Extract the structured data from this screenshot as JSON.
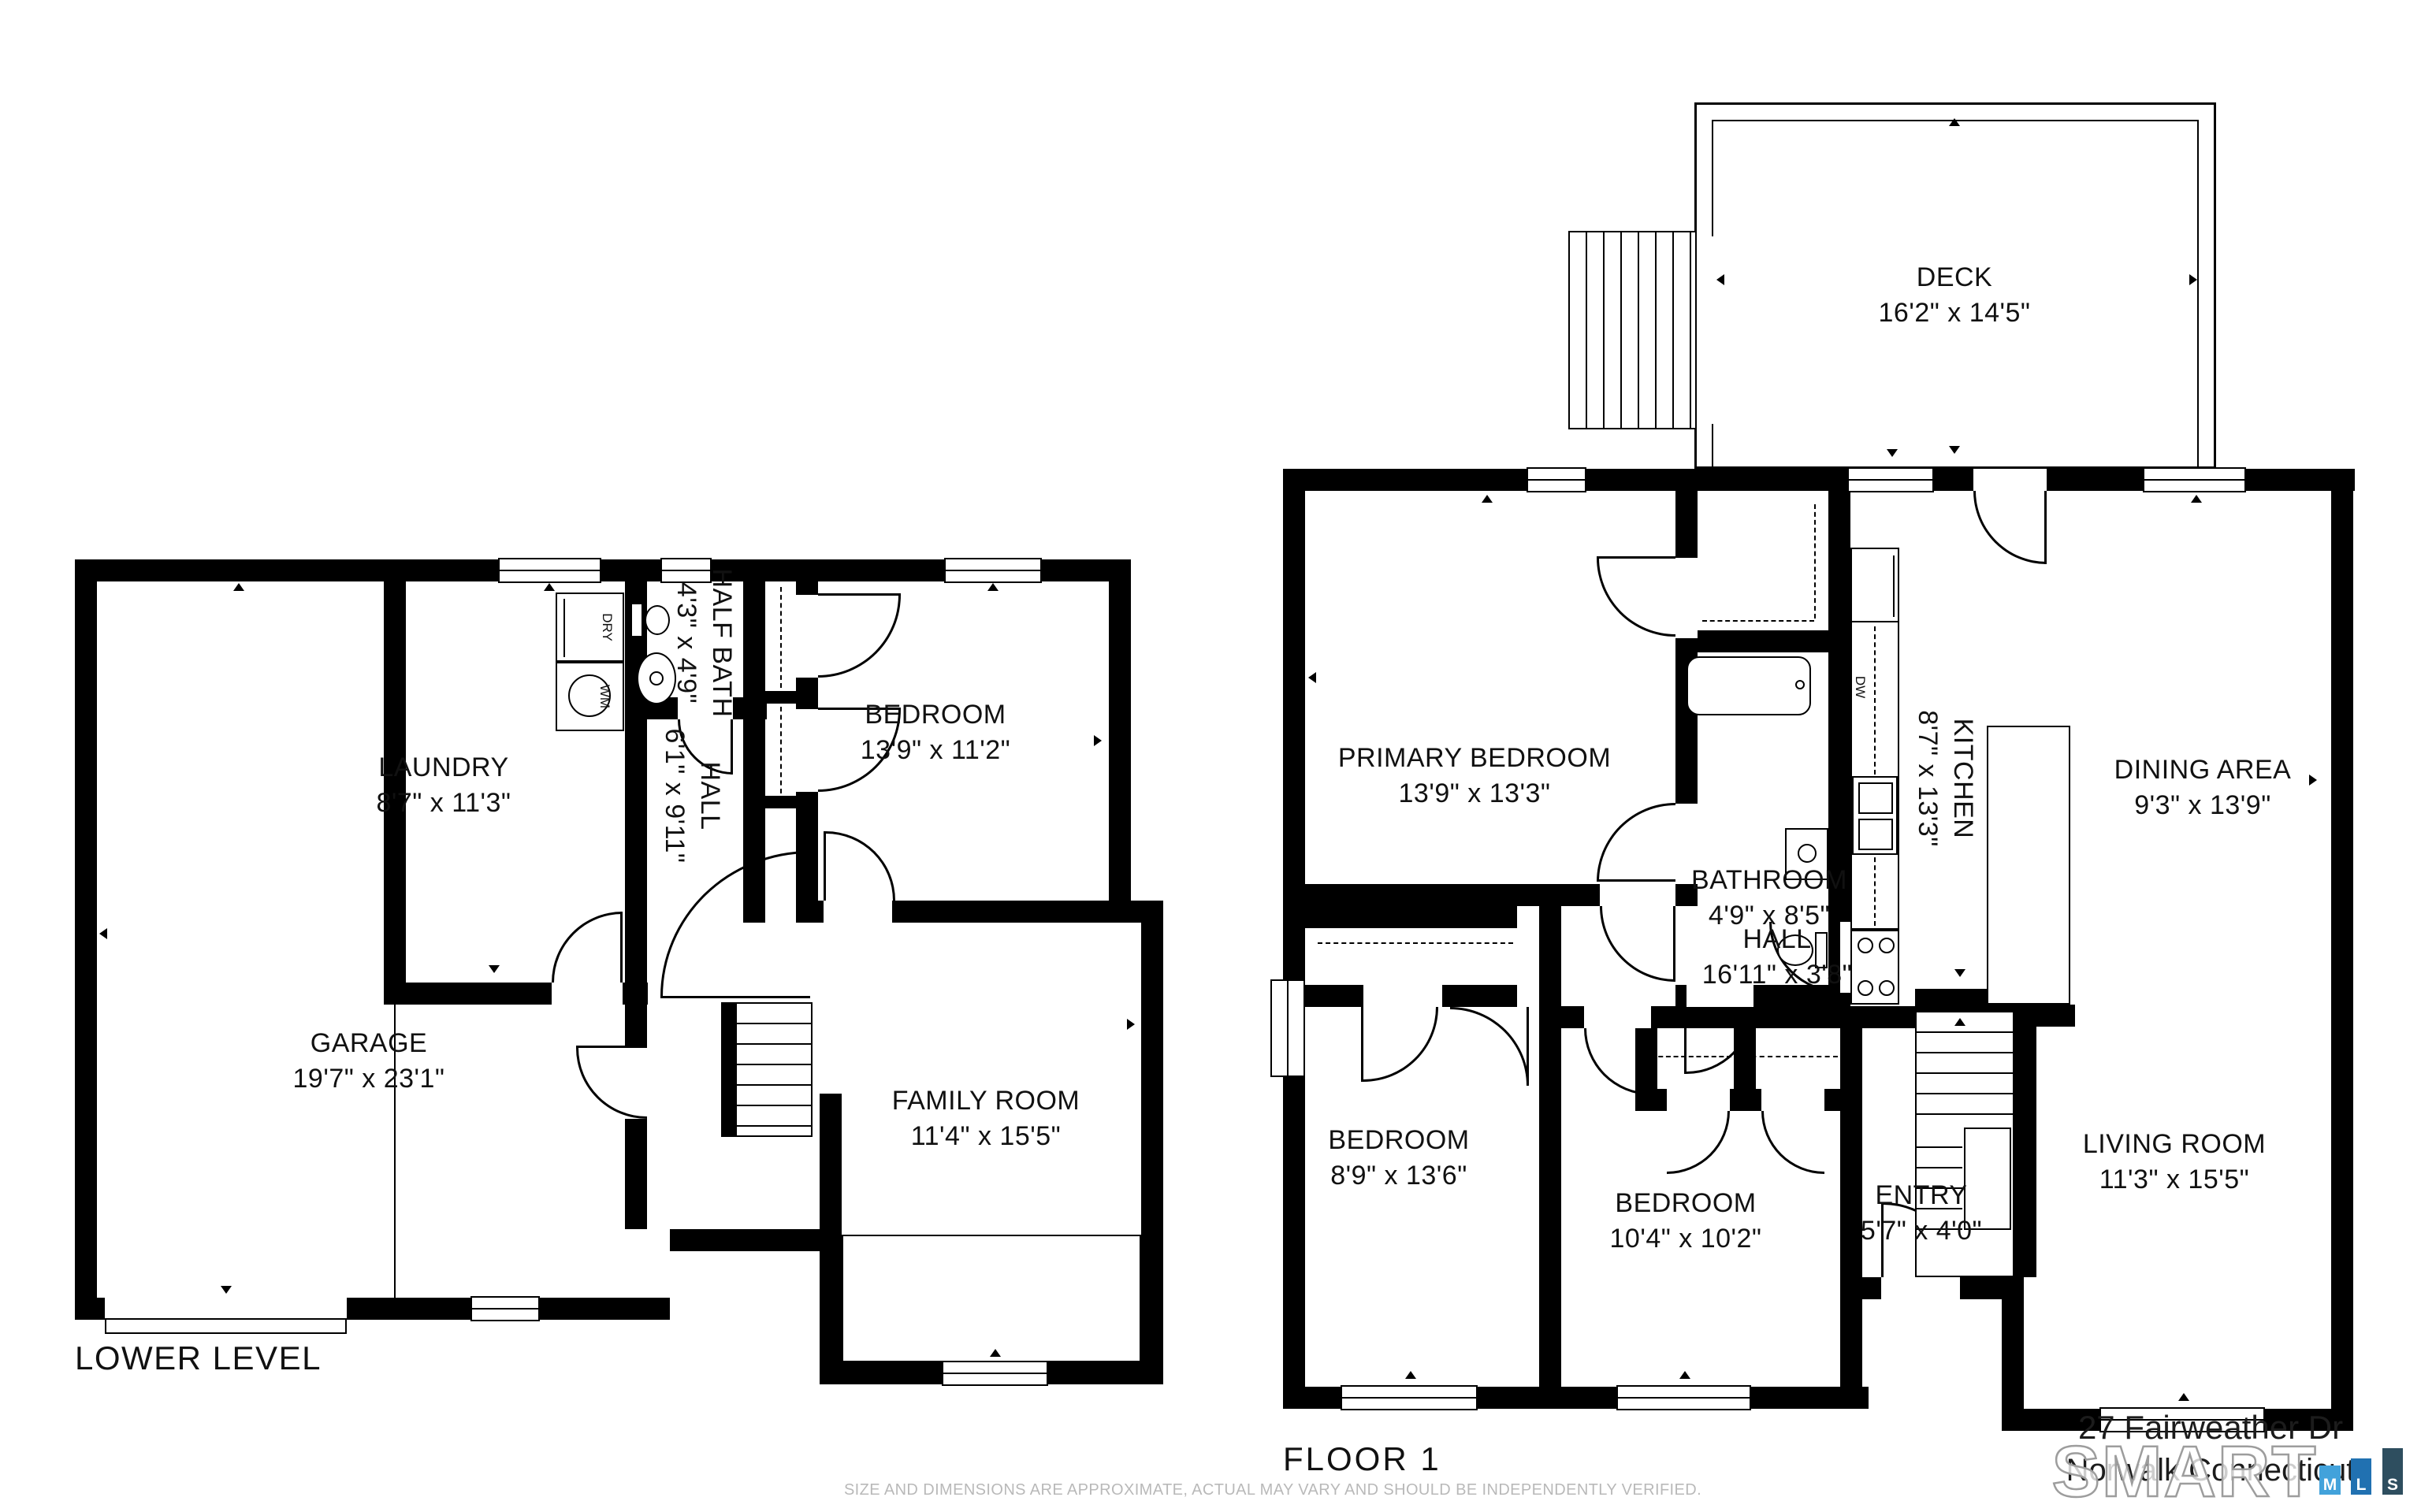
{
  "plans": {
    "lower": {
      "title": "LOWER LEVEL",
      "rooms": {
        "garage": {
          "name": "GARAGE",
          "dims": "19'7\" x 23'1\""
        },
        "laundry": {
          "name": "LAUNDRY",
          "dims": "8'7\" x 11'3\""
        },
        "half_bath": {
          "name": "HALF BATH",
          "dims": "4'3\" x 4'9\""
        },
        "hall": {
          "name": "HALL",
          "dims": "6'1\" x 9'11\""
        },
        "bedroom": {
          "name": "BEDROOM",
          "dims": "13'9\" x 11'2\""
        },
        "family_room": {
          "name": "FAMILY ROOM",
          "dims": "11'4\" x 15'5\""
        }
      },
      "appliances": {
        "dryer": "DRY",
        "washer": "WM"
      }
    },
    "floor1": {
      "title": "FLOOR 1",
      "rooms": {
        "deck": {
          "name": "DECK",
          "dims": "16'2\" x 14'5\""
        },
        "primary_bedroom": {
          "name": "PRIMARY BEDROOM",
          "dims": "13'9\" x 13'3\""
        },
        "bathroom": {
          "name": "BATHROOM",
          "dims": "4'9\" x 8'5\""
        },
        "kitchen": {
          "name": "KITCHEN",
          "dims": "8'7\" x 13'3\""
        },
        "dining": {
          "name": "DINING AREA",
          "dims": "9'3\" x 13'9\""
        },
        "hall": {
          "name": "HALL",
          "dims": "16'11\" x 3'8\""
        },
        "bedroom_left": {
          "name": "BEDROOM",
          "dims": "8'9\" x 13'6\""
        },
        "bedroom_mid": {
          "name": "BEDROOM",
          "dims": "10'4\" x 10'2\""
        },
        "entry": {
          "name": "ENTRY",
          "dims": "5'7\" x 4'0\""
        },
        "living": {
          "name": "LIVING ROOM",
          "dims": "11'3\" x 15'5\""
        }
      },
      "appliances": {
        "dishwasher": "DW"
      }
    }
  },
  "footer": {
    "address_line1": "27 Fairweather Dr",
    "address_line2": "Norwalk Connecticut",
    "watermark": "SMART",
    "mls": {
      "m": {
        "label": "M",
        "color": "#42A2DB"
      },
      "l": {
        "label": "L",
        "color": "#2171B1"
      },
      "s": {
        "label": "S",
        "color": "#2E4E5F"
      }
    },
    "disclaimer": "SIZE AND DIMENSIONS ARE APPROXIMATE, ACTUAL MAY VARY AND SHOULD BE INDEPENDENTLY VERIFIED."
  }
}
